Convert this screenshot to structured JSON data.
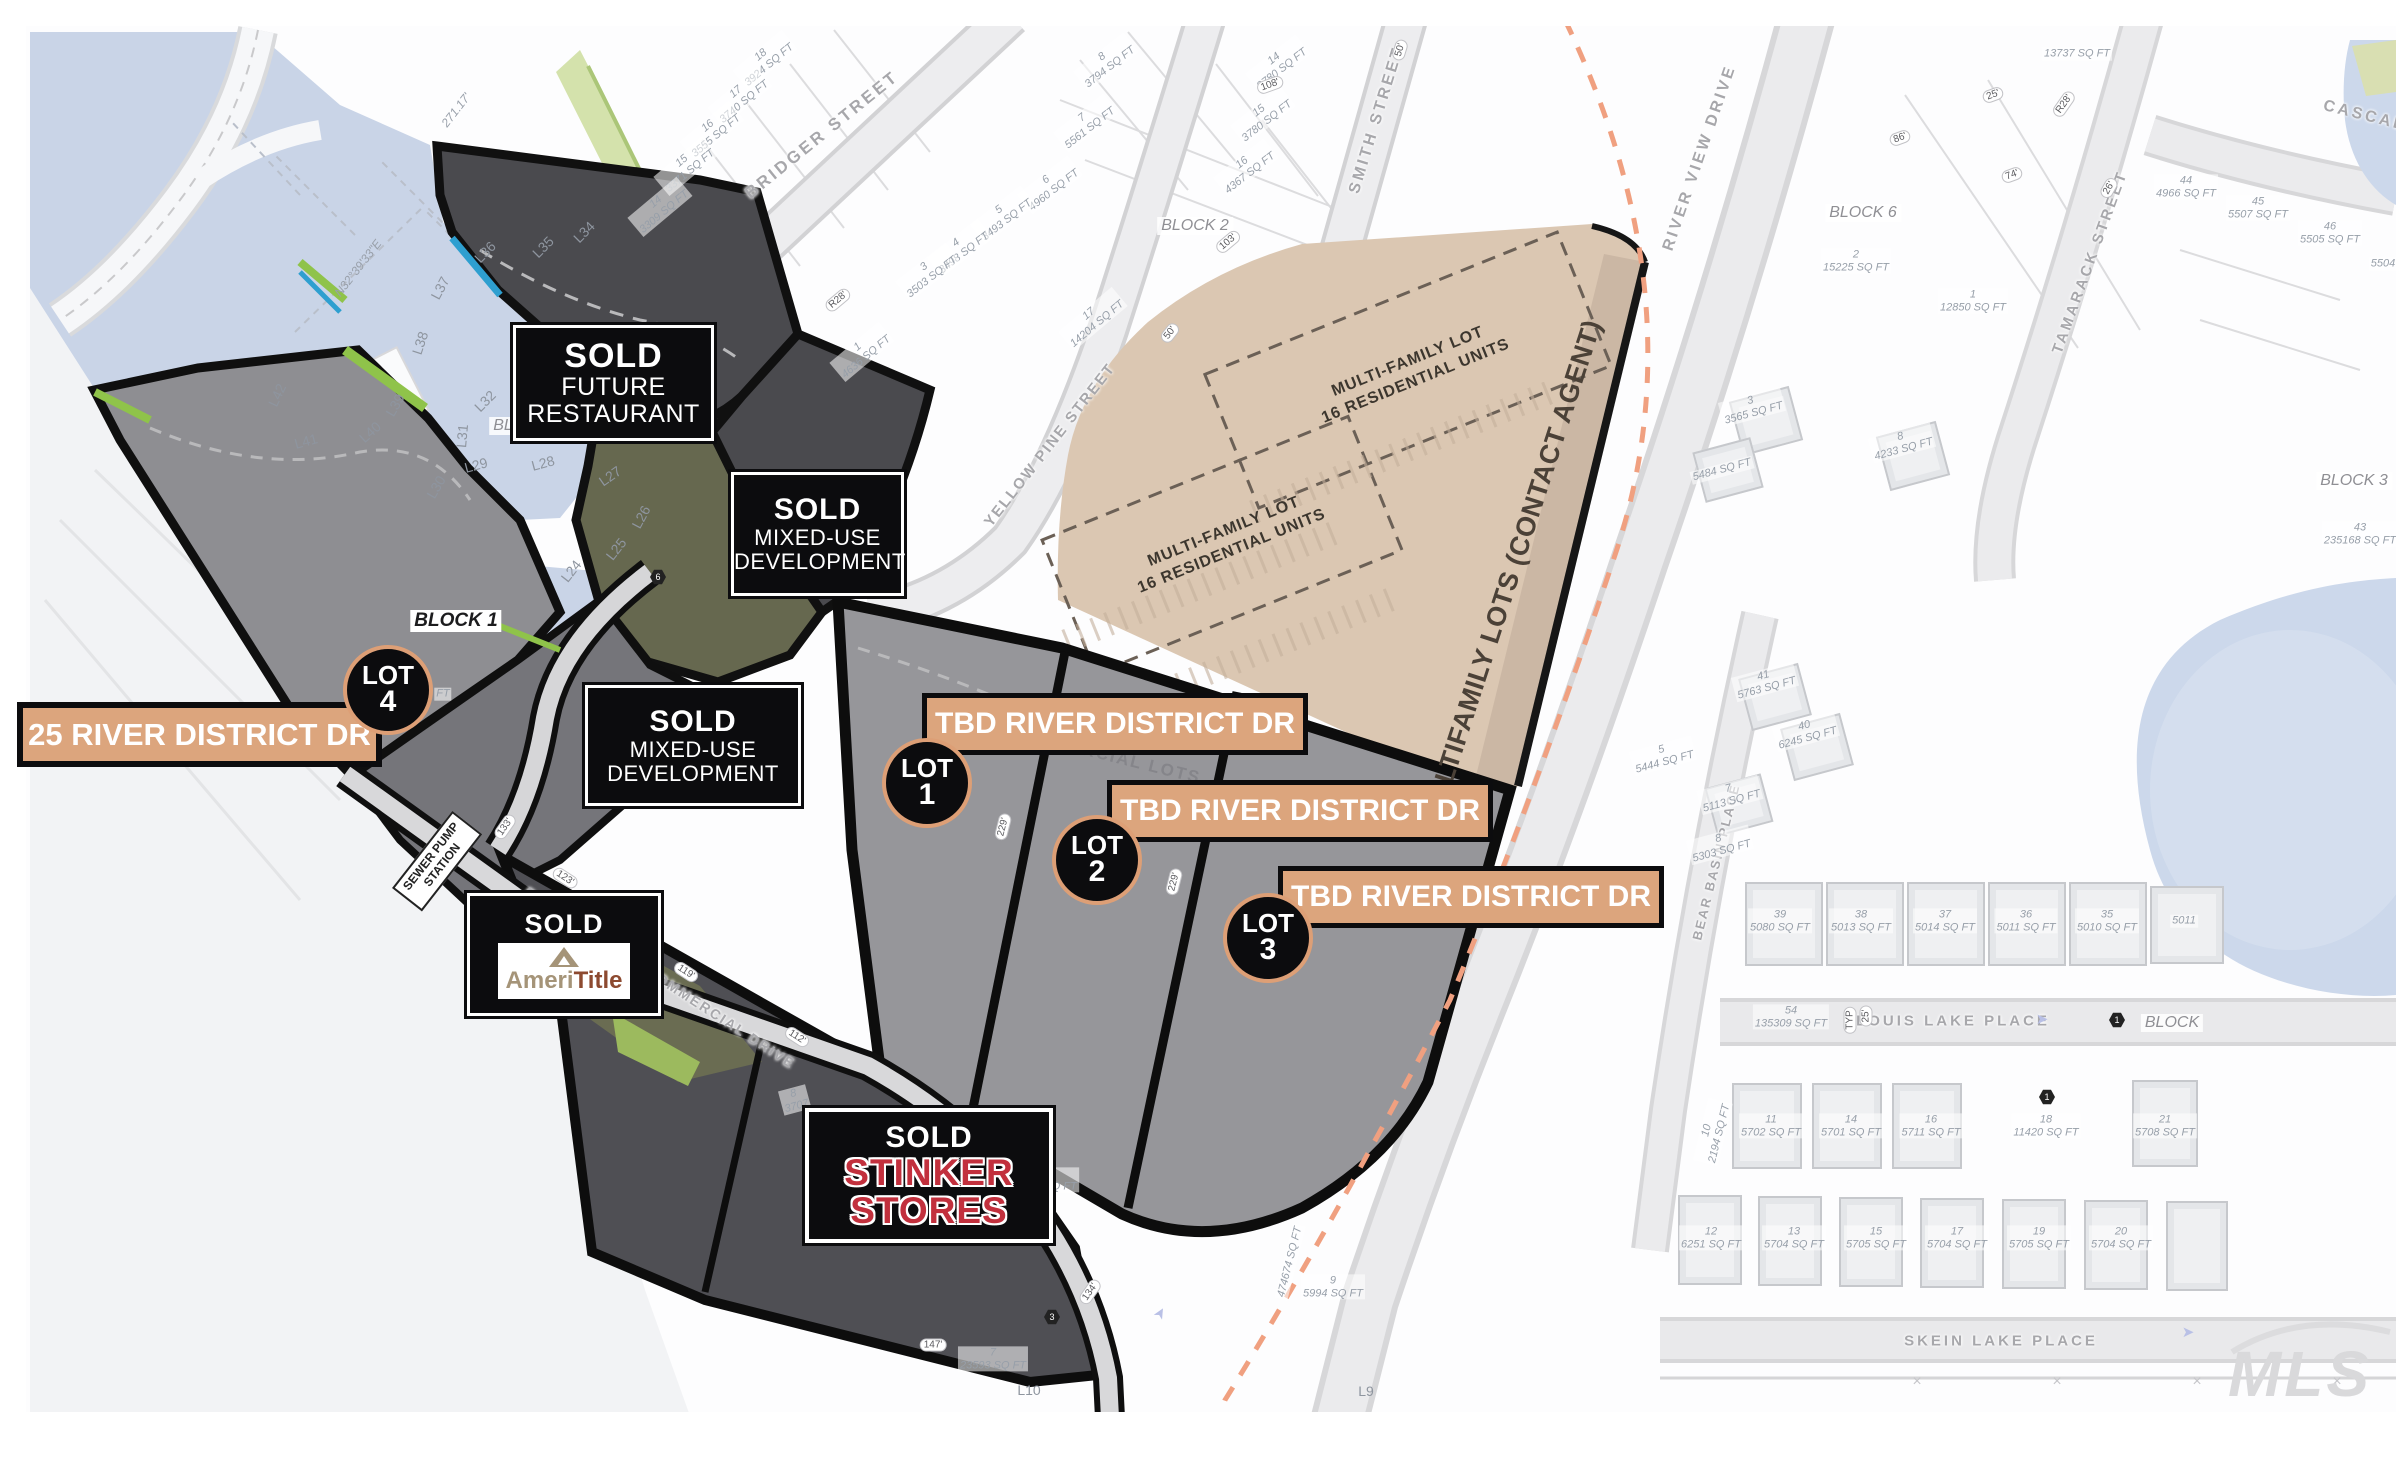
{
  "title_labels": {
    "sold_restaurant": {
      "sold": "SOLD",
      "l2": "FUTURE",
      "l3": "RESTAURANT"
    },
    "sold_mixed": {
      "sold": "SOLD",
      "l2": "MIXED-USE",
      "l3": "DEVELOPMENT"
    },
    "sold_ameri": {
      "sold": "SOLD",
      "brand_left": "Ameri",
      "brand_right": "Title"
    },
    "sold_stinker": {
      "sold": "SOLD",
      "l2": "STINKER",
      "l3": "STORES"
    },
    "addr_lot4": "25 RIVER DISTRICT DR",
    "tbd": "TBD RIVER DISTRICT DR",
    "contact_strip": "MULTIFAMILY LOTS (CONTACT AGENT)",
    "mf_l1": "MULTI-FAMILY LOT",
    "mf_l2": "16 RESIDENTIAL UNITS",
    "commercial_lots": "COMMERCIAL LOTS",
    "sewer_l1": "SEWER PUMP",
    "sewer_l2": "STATION",
    "watermark": "MLS"
  },
  "survey": {
    "bearing": "N32°39'33\"E",
    "bearing_len": "271.17'"
  },
  "lot_badges": [
    {
      "word": "LOT",
      "num": "1",
      "x": 927,
      "y": 783
    },
    {
      "word": "LOT",
      "num": "2",
      "x": 1097,
      "y": 860
    },
    {
      "word": "LOT",
      "num": "3",
      "x": 1268,
      "y": 938
    },
    {
      "word": "LOT",
      "num": "4",
      "x": 388,
      "y": 690
    }
  ],
  "streets": [
    {
      "t": "BRIDGER STREET",
      "x": 822,
      "y": 135,
      "r": -39,
      "s": 17,
      "ls": 3
    },
    {
      "t": "SMITH STREET",
      "x": 1377,
      "y": 120,
      "r": -73,
      "s": 16,
      "ls": 3
    },
    {
      "t": "YELLOW PINE STREET",
      "x": 1050,
      "y": 445,
      "r": -52,
      "s": 15,
      "ls": 2
    },
    {
      "t": "RIVER VIEW DRIVE",
      "x": 1700,
      "y": 158,
      "r": -71,
      "s": 16,
      "ls": 3
    },
    {
      "t": "TAMARACK STREET",
      "x": 2090,
      "y": 262,
      "r": -70,
      "s": 15,
      "ls": 3
    },
    {
      "t": "CASCADE",
      "x": 2372,
      "y": 118,
      "r": 14,
      "s": 16,
      "ls": 3
    },
    {
      "t": "BEAR BASIN PLACE",
      "x": 1716,
      "y": 862,
      "r": -76,
      "s": 13,
      "ls": 2
    },
    {
      "t": "LOUIS LAKE PLACE",
      "x": 1953,
      "y": 1021,
      "r": 0,
      "s": 15,
      "ls": 3
    },
    {
      "t": "SKEIN LAKE PLACE",
      "x": 2001,
      "y": 1341,
      "r": 0,
      "s": 15,
      "ls": 3
    },
    {
      "t": "RIVER DISTRICT COMMERCIAL DRIVE",
      "x": 660,
      "y": 978,
      "r": 33,
      "s": 14,
      "ls": 2
    }
  ],
  "blocks": [
    {
      "t": "BLOCK 1",
      "x": 456,
      "y": 621,
      "strong": true
    },
    {
      "t": "BLOCK 1",
      "x": 527,
      "y": 426
    },
    {
      "t": "BLOCK 2",
      "x": 1195,
      "y": 226
    },
    {
      "t": "BLOCK 6",
      "x": 1863,
      "y": 213
    },
    {
      "t": "BLOCK 3",
      "x": 2354,
      "y": 481
    },
    {
      "t": "BLOCK",
      "x": 2172,
      "y": 1023
    }
  ],
  "parcel_labels": [
    {
      "n": "18",
      "s": "3924 SQ FT",
      "x": 765,
      "y": 60,
      "r": -40
    },
    {
      "n": "17",
      "s": "3740 SQ FT",
      "x": 740,
      "y": 97,
      "r": -40
    },
    {
      "n": "16",
      "s": "3555 SQ FT",
      "x": 712,
      "y": 131,
      "r": -40
    },
    {
      "n": "15",
      "s": "3371 SQ FT",
      "x": 686,
      "y": 166,
      "r": -40
    },
    {
      "n": "14",
      "s": "3309 SQ FT",
      "x": 660,
      "y": 207,
      "r": -40
    },
    {
      "n": "8",
      "s": "3794 SQ FT",
      "x": 1106,
      "y": 62,
      "r": -38
    },
    {
      "n": "7",
      "s": "5561 SQ FT",
      "x": 1086,
      "y": 123,
      "r": -38
    },
    {
      "n": "6",
      "s": "4960 SQ FT",
      "x": 1050,
      "y": 185,
      "r": -38
    },
    {
      "n": "5",
      "s": "3493 SQ FT",
      "x": 1003,
      "y": 215,
      "r": -38
    },
    {
      "n": "4",
      "s": "3498 SQ FT",
      "x": 960,
      "y": 248,
      "r": -38
    },
    {
      "n": "3",
      "s": "3503 SQ FT",
      "x": 928,
      "y": 272,
      "r": -38
    },
    {
      "n": "14",
      "s": "3780 SQ FT",
      "x": 1278,
      "y": 64,
      "r": -38
    },
    {
      "n": "15",
      "s": "3780 SQ FT",
      "x": 1263,
      "y": 116,
      "r": -38
    },
    {
      "n": "16",
      "s": "4367 SQ FT",
      "x": 1246,
      "y": 168,
      "r": -38
    },
    {
      "n": "17",
      "s": "14204 SQ FT",
      "x": 1093,
      "y": 319,
      "r": -40
    },
    {
      "n": "1",
      "s": "4636 SQ FT",
      "x": 862,
      "y": 352,
      "r": -40
    },
    {
      "n": "",
      "s": "13737 SQ FT",
      "x": 2077,
      "y": 54,
      "r": 0
    },
    {
      "n": "2",
      "s": "15225 SQ FT",
      "x": 1856,
      "y": 261,
      "r": 0
    },
    {
      "n": "1",
      "s": "12850 SQ FT",
      "x": 1973,
      "y": 301,
      "r": 0
    },
    {
      "n": "44",
      "s": "4966 SQ FT",
      "x": 2186,
      "y": 187,
      "r": 0
    },
    {
      "n": "45",
      "s": "5507 SQ FT",
      "x": 2258,
      "y": 208,
      "r": 0
    },
    {
      "n": "46",
      "s": "5505 SQ FT",
      "x": 2330,
      "y": 233,
      "r": 0
    },
    {
      "n": "",
      "s": "5504",
      "x": 2383,
      "y": 264,
      "r": 0
    },
    {
      "n": "43",
      "s": "235168 SQ FT",
      "x": 2360,
      "y": 534,
      "r": 0
    },
    {
      "n": "3",
      "s": "3565 SQ FT",
      "x": 1752,
      "y": 407,
      "r": -15
    },
    {
      "n": "8",
      "s": "4233 SQ FT",
      "x": 1902,
      "y": 443,
      "r": -15
    },
    {
      "n": "",
      "s": "5484 SQ FT",
      "x": 1722,
      "y": 470,
      "r": -15
    },
    {
      "n": "41",
      "s": "5763 SQ FT",
      "x": 1765,
      "y": 682,
      "r": -15
    },
    {
      "n": "40",
      "s": "6245 SQ FT",
      "x": 1806,
      "y": 732,
      "r": -15
    },
    {
      "n": "5",
      "s": "5444 SQ FT",
      "x": 1663,
      "y": 756,
      "r": -15
    },
    {
      "n": "7",
      "s": "5113 SQ FT",
      "x": 1730,
      "y": 795,
      "r": -15
    },
    {
      "n": "8",
      "s": "5303 SQ FT",
      "x": 1720,
      "y": 845,
      "r": -15
    },
    {
      "n": "39",
      "s": "5080 SQ FT",
      "x": 1780,
      "y": 921,
      "r": 0
    },
    {
      "n": "38",
      "s": "5013 SQ FT",
      "x": 1861,
      "y": 921,
      "r": 0
    },
    {
      "n": "37",
      "s": "5014 SQ FT",
      "x": 1945,
      "y": 921,
      "r": 0
    },
    {
      "n": "36",
      "s": "5011 SQ FT",
      "x": 2026,
      "y": 921,
      "r": 0
    },
    {
      "n": "35",
      "s": "5010 SQ FT",
      "x": 2107,
      "y": 921,
      "r": 0
    },
    {
      "n": "",
      "s": "5011",
      "x": 2184,
      "y": 921,
      "r": 0
    },
    {
      "n": "54",
      "s": "135309 SQ FT",
      "x": 1791,
      "y": 1017,
      "r": 0
    },
    {
      "n": "11",
      "s": "5702 SQ FT",
      "x": 1771,
      "y": 1126,
      "r": 0
    },
    {
      "n": "14",
      "s": "5701 SQ FT",
      "x": 1851,
      "y": 1126,
      "r": 0
    },
    {
      "n": "16",
      "s": "5711 SQ FT",
      "x": 1931,
      "y": 1126,
      "r": 0
    },
    {
      "n": "18",
      "s": "11420 SQ FT",
      "x": 2046,
      "y": 1126,
      "r": 0
    },
    {
      "n": "21",
      "s": "5708 SQ FT",
      "x": 2165,
      "y": 1126,
      "r": 0
    },
    {
      "n": "10",
      "s": "2194 SQ FT",
      "x": 1713,
      "y": 1132,
      "r": -76
    },
    {
      "n": "12",
      "s": "6251 SQ FT",
      "x": 1711,
      "y": 1238,
      "r": 0
    },
    {
      "n": "13",
      "s": "5704 SQ FT",
      "x": 1794,
      "y": 1238,
      "r": 0
    },
    {
      "n": "15",
      "s": "5705 SQ FT",
      "x": 1876,
      "y": 1238,
      "r": 0
    },
    {
      "n": "17",
      "s": "5704 SQ FT",
      "x": 1957,
      "y": 1238,
      "r": 0
    },
    {
      "n": "19",
      "s": "5705 SQ FT",
      "x": 2039,
      "y": 1238,
      "r": 0
    },
    {
      "n": "20",
      "s": "5704 SQ FT",
      "x": 2121,
      "y": 1238,
      "r": 0
    },
    {
      "n": "9",
      "s": "5994 SQ FT",
      "x": 1333,
      "y": 1287,
      "r": 0
    },
    {
      "n": "",
      "s": "474674 SQ FT",
      "x": 1290,
      "y": 1262,
      "r": -76
    },
    {
      "n": "7",
      "s": "23593 SQ FT",
      "x": 993,
      "y": 1359,
      "r": 0
    },
    {
      "n": "8",
      "s": "3707",
      "x": 795,
      "y": 1100,
      "r": -15
    },
    {
      "n": "6",
      "s": "02 SQ FT",
      "x": 1053,
      "y": 1180,
      "r": 0
    },
    {
      "n": "",
      "s": "FT",
      "x": 443,
      "y": 694,
      "r": 0
    }
  ],
  "line_labels": [
    {
      "t": "L24",
      "x": 571,
      "y": 571,
      "r": -52
    },
    {
      "t": "L25",
      "x": 616,
      "y": 549,
      "r": -52
    },
    {
      "t": "L26",
      "x": 641,
      "y": 517,
      "r": -62
    },
    {
      "t": "L27",
      "x": 610,
      "y": 476,
      "r": -35
    },
    {
      "t": "L28",
      "x": 543,
      "y": 463,
      "r": -15
    },
    {
      "t": "L29",
      "x": 476,
      "y": 465,
      "r": -15
    },
    {
      "t": "L30",
      "x": 436,
      "y": 487,
      "r": -60
    },
    {
      "t": "L31",
      "x": 462,
      "y": 436,
      "r": -85
    },
    {
      "t": "L32",
      "x": 485,
      "y": 401,
      "r": -45
    },
    {
      "t": "L34",
      "x": 584,
      "y": 232,
      "r": -45
    },
    {
      "t": "L35",
      "x": 543,
      "y": 247,
      "r": -45
    },
    {
      "t": "L36",
      "x": 485,
      "y": 252,
      "r": -45
    },
    {
      "t": "L37",
      "x": 440,
      "y": 288,
      "r": -62
    },
    {
      "t": "L38",
      "x": 420,
      "y": 343,
      "r": -72
    },
    {
      "t": "L39",
      "x": 395,
      "y": 405,
      "r": -60
    },
    {
      "t": "L40",
      "x": 370,
      "y": 432,
      "r": -42
    },
    {
      "t": "L41",
      "x": 306,
      "y": 441,
      "r": -15
    },
    {
      "t": "L42",
      "x": 277,
      "y": 395,
      "r": -65
    },
    {
      "t": "L9",
      "x": 1366,
      "y": 1391,
      "r": 0
    },
    {
      "t": "L10",
      "x": 1029,
      "y": 1390,
      "r": 0
    }
  ],
  "dims": [
    {
      "t": "229'",
      "x": 1003,
      "y": 827,
      "r": -76
    },
    {
      "t": "229'",
      "x": 1174,
      "y": 882,
      "r": -76
    },
    {
      "t": "123'",
      "x": 565,
      "y": 878,
      "r": 33
    },
    {
      "t": "119'",
      "x": 686,
      "y": 972,
      "r": 33
    },
    {
      "t": "112'",
      "x": 797,
      "y": 1037,
      "r": 33
    },
    {
      "t": "133'",
      "x": 505,
      "y": 827,
      "r": -55
    },
    {
      "t": "134'",
      "x": 1090,
      "y": 1292,
      "r": -55
    },
    {
      "t": "147'",
      "x": 933,
      "y": 1345,
      "r": 0
    },
    {
      "t": "50'",
      "x": 1170,
      "y": 333,
      "r": -52
    },
    {
      "t": "50'",
      "x": 1400,
      "y": 50,
      "r": -73
    },
    {
      "t": "25'",
      "x": 1993,
      "y": 95,
      "r": -20
    },
    {
      "t": "26'",
      "x": 2109,
      "y": 188,
      "r": -60
    },
    {
      "t": "R28'",
      "x": 838,
      "y": 300,
      "r": -40
    },
    {
      "t": "R28'",
      "x": 2064,
      "y": 104,
      "r": -55
    },
    {
      "t": "25'",
      "x": 1866,
      "y": 1016,
      "r": -90
    },
    {
      "t": "TYP",
      "x": 1850,
      "y": 1020,
      "r": -90
    },
    {
      "t": "86'",
      "x": 1900,
      "y": 138,
      "r": -20
    },
    {
      "t": "74'",
      "x": 2012,
      "y": 175,
      "r": -20
    },
    {
      "t": "103'",
      "x": 1228,
      "y": 242,
      "r": -40
    },
    {
      "t": "108'",
      "x": 1270,
      "y": 85,
      "r": -20
    }
  ],
  "markers": [
    {
      "t": "6",
      "x": 815,
      "y": 572
    },
    {
      "t": "6",
      "x": 658,
      "y": 577
    },
    {
      "t": "3",
      "x": 1052,
      "y": 1317
    },
    {
      "t": "1",
      "x": 2117,
      "y": 1020
    },
    {
      "t": "1",
      "x": 2047,
      "y": 1097
    }
  ],
  "arrows": [
    {
      "x": 2042,
      "y": 1019,
      "r": 0
    },
    {
      "x": 2188,
      "y": 1332,
      "r": 0
    },
    {
      "x": 1160,
      "y": 1313,
      "r": -60
    }
  ],
  "fence_x": [
    1917,
    2057,
    2197,
    2337
  ],
  "colors": {
    "water": "#c9d4e7",
    "multifamily_tan": "#dbc7b2",
    "multifamily_strip": "#cbb7a4",
    "label_tan": "#dca57d",
    "lot_ring": "#dd9f76",
    "dark_parcel": "#4a4a4e",
    "mid_parcel": "#8e8e92",
    "commercial_gray": "#96969a",
    "olive": "#66684f",
    "bright_green": "#9cba5e",
    "stinker_red": "#c2303d",
    "ameri_tan": "#a59478",
    "ameri_red": "#8d4a30",
    "orange_dash": "#f0a080"
  },
  "decor": {
    "houses": [
      [
        1745,
        882,
        74,
        80
      ],
      [
        1826,
        882,
        74,
        80
      ],
      [
        1907,
        882,
        74,
        80
      ],
      [
        1988,
        882,
        74,
        80
      ],
      [
        2069,
        882,
        74,
        80
      ],
      [
        2150,
        886,
        70,
        74
      ],
      [
        1732,
        1083,
        66,
        82
      ],
      [
        1812,
        1083,
        66,
        82
      ],
      [
        1892,
        1083,
        66,
        82
      ],
      [
        2132,
        1080,
        62,
        83
      ],
      [
        1678,
        1195,
        60,
        86
      ],
      [
        1758,
        1196,
        60,
        86
      ],
      [
        1839,
        1197,
        60,
        86
      ],
      [
        1920,
        1198,
        60,
        86
      ],
      [
        2002,
        1199,
        60,
        86
      ],
      [
        2084,
        1200,
        60,
        86
      ],
      [
        2166,
        1201,
        58,
        86
      ],
      [
        1735,
        393,
        58,
        52,
        -15
      ],
      [
        1882,
        428,
        58,
        52,
        -15
      ],
      [
        1698,
        444,
        56,
        48,
        -15
      ],
      [
        1744,
        670,
        58,
        50,
        -15
      ],
      [
        1786,
        720,
        58,
        50,
        -15
      ],
      [
        1710,
        780,
        54,
        46,
        -15
      ]
    ]
  }
}
